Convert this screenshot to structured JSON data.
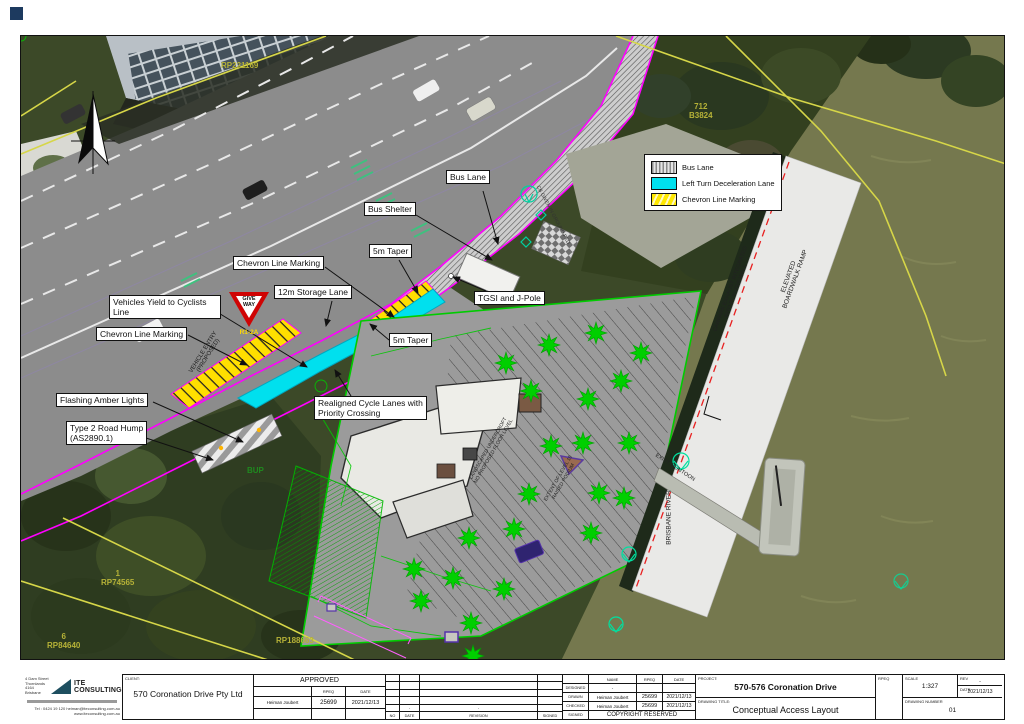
{
  "map": {
    "legend": {
      "items": [
        {
          "label": "Bus Lane"
        },
        {
          "label": "Left Turn Deceleration Lane"
        },
        {
          "label": "Chevron Line Marking"
        }
      ]
    },
    "callouts": {
      "bus_lane": "Bus Lane",
      "bus_shelter": "Bus Shelter",
      "taper_top": "5m Taper",
      "chevron_top": "Chevron Line Marking",
      "storage": "12m Storage Lane",
      "tgsi": "TGSI and J-Pole",
      "yield": "Vehicles Yield to Cyclists Line",
      "chevron_low": "Chevron Line Marking",
      "taper_low": "5m Taper",
      "flashing": "Flashing Amber Lights",
      "hump": "Type 2 Road Hump\n(AS2890.1)",
      "realigned": "Realigned Cycle Lanes with\nPriority Crossing"
    },
    "labels": {
      "give_way": "GIVE\nWAY",
      "r1_2a": "R1-2A",
      "bup": "BUP",
      "vehicle_entry": "VEHICLE ENTRY\n(PROPOSED)",
      "survey_note": "CB GIVEN IN GROUND PED",
      "landscaped": "LANDSCAPED UNDERCROFT\nNO PROPOSED FLOOR LEVEL",
      "extent": "EXTENT OF LEVEL 10 RAISED PODIUM",
      "boardwalk": "ELEVATED\nBOARDWALK RAMP",
      "carpark": "CARPARK EXHAUST INTEGRATED\nINTO PLANTER WALL",
      "river": "BRISBANE RIVER",
      "pontoon": "EXIST. PONTOON",
      "lot_rp221169": "RP221169",
      "lot_712": "712\nB3824",
      "lot_1": "1\nRP74565",
      "lot_6": "6\nRP84640",
      "lot_rp188663": "RP188663"
    }
  },
  "title_block": {
    "client_label": "CLIENT:",
    "client": "570 Coronation Drive Pty Ltd",
    "approved": {
      "title": "APPROVED",
      "rpeq_label": "RPEQ",
      "date_label": "DATE",
      "name": "Heiman Joubert",
      "rpeq": "25699",
      "date": "2021/12/13"
    },
    "revision": {
      "no_label": "NO",
      "date_label": "DATE",
      "revision_label": "REVISION",
      "signed_label": "SIGNED",
      "dash": "-"
    },
    "personnel": {
      "name_label": "NAME",
      "rpeq_label": "RPEQ",
      "date_label": "DATE",
      "designed_label": "DESIGNED",
      "designed_name": "-",
      "drawn_label": "DRAWN",
      "drawn_name": "Heiman Joubert",
      "drawn_rpeq": "25699",
      "drawn_date": "2021/12/13",
      "checked_label": "CHECKED",
      "checked_name": "Heiman Joubert",
      "checked_rpeq": "25699",
      "checked_date": "2021/12/13",
      "signed_label": "SIGNED",
      "copyright": "COPYRIGHT RESERVED"
    },
    "project_label": "PROJECT:",
    "project": "570-576 Coronation Drive",
    "drawing_title_label": "DRAWING TITLE:",
    "drawing_title": "Conceptual Access Layout",
    "rpeq_label": "RPEQ",
    "scale_label": "SCALE",
    "scale": "1:327",
    "rev_label": "REV",
    "rev": "-",
    "date_label": "DATE",
    "date": "2021/12/13",
    "drawing_number_label": "DRAWING NUMBER",
    "drawing_number": "01"
  },
  "consultant": {
    "name": "ITE CONSULTING",
    "address": "4 Dam Street\nThornlands\n4164\nBrisbane",
    "contact": "Tel : 0424 19 120   heiman@iteconsulting.com.au\nwww.iteconsulting.com.au"
  },
  "colors": {
    "magenta": "#ff00ff",
    "cyan": "#00e0ee",
    "chevron_yellow": "#ffe000",
    "cad_green": "#00c800",
    "boundary_yellow": "#d6d648",
    "red_dash": "#ff3030"
  }
}
